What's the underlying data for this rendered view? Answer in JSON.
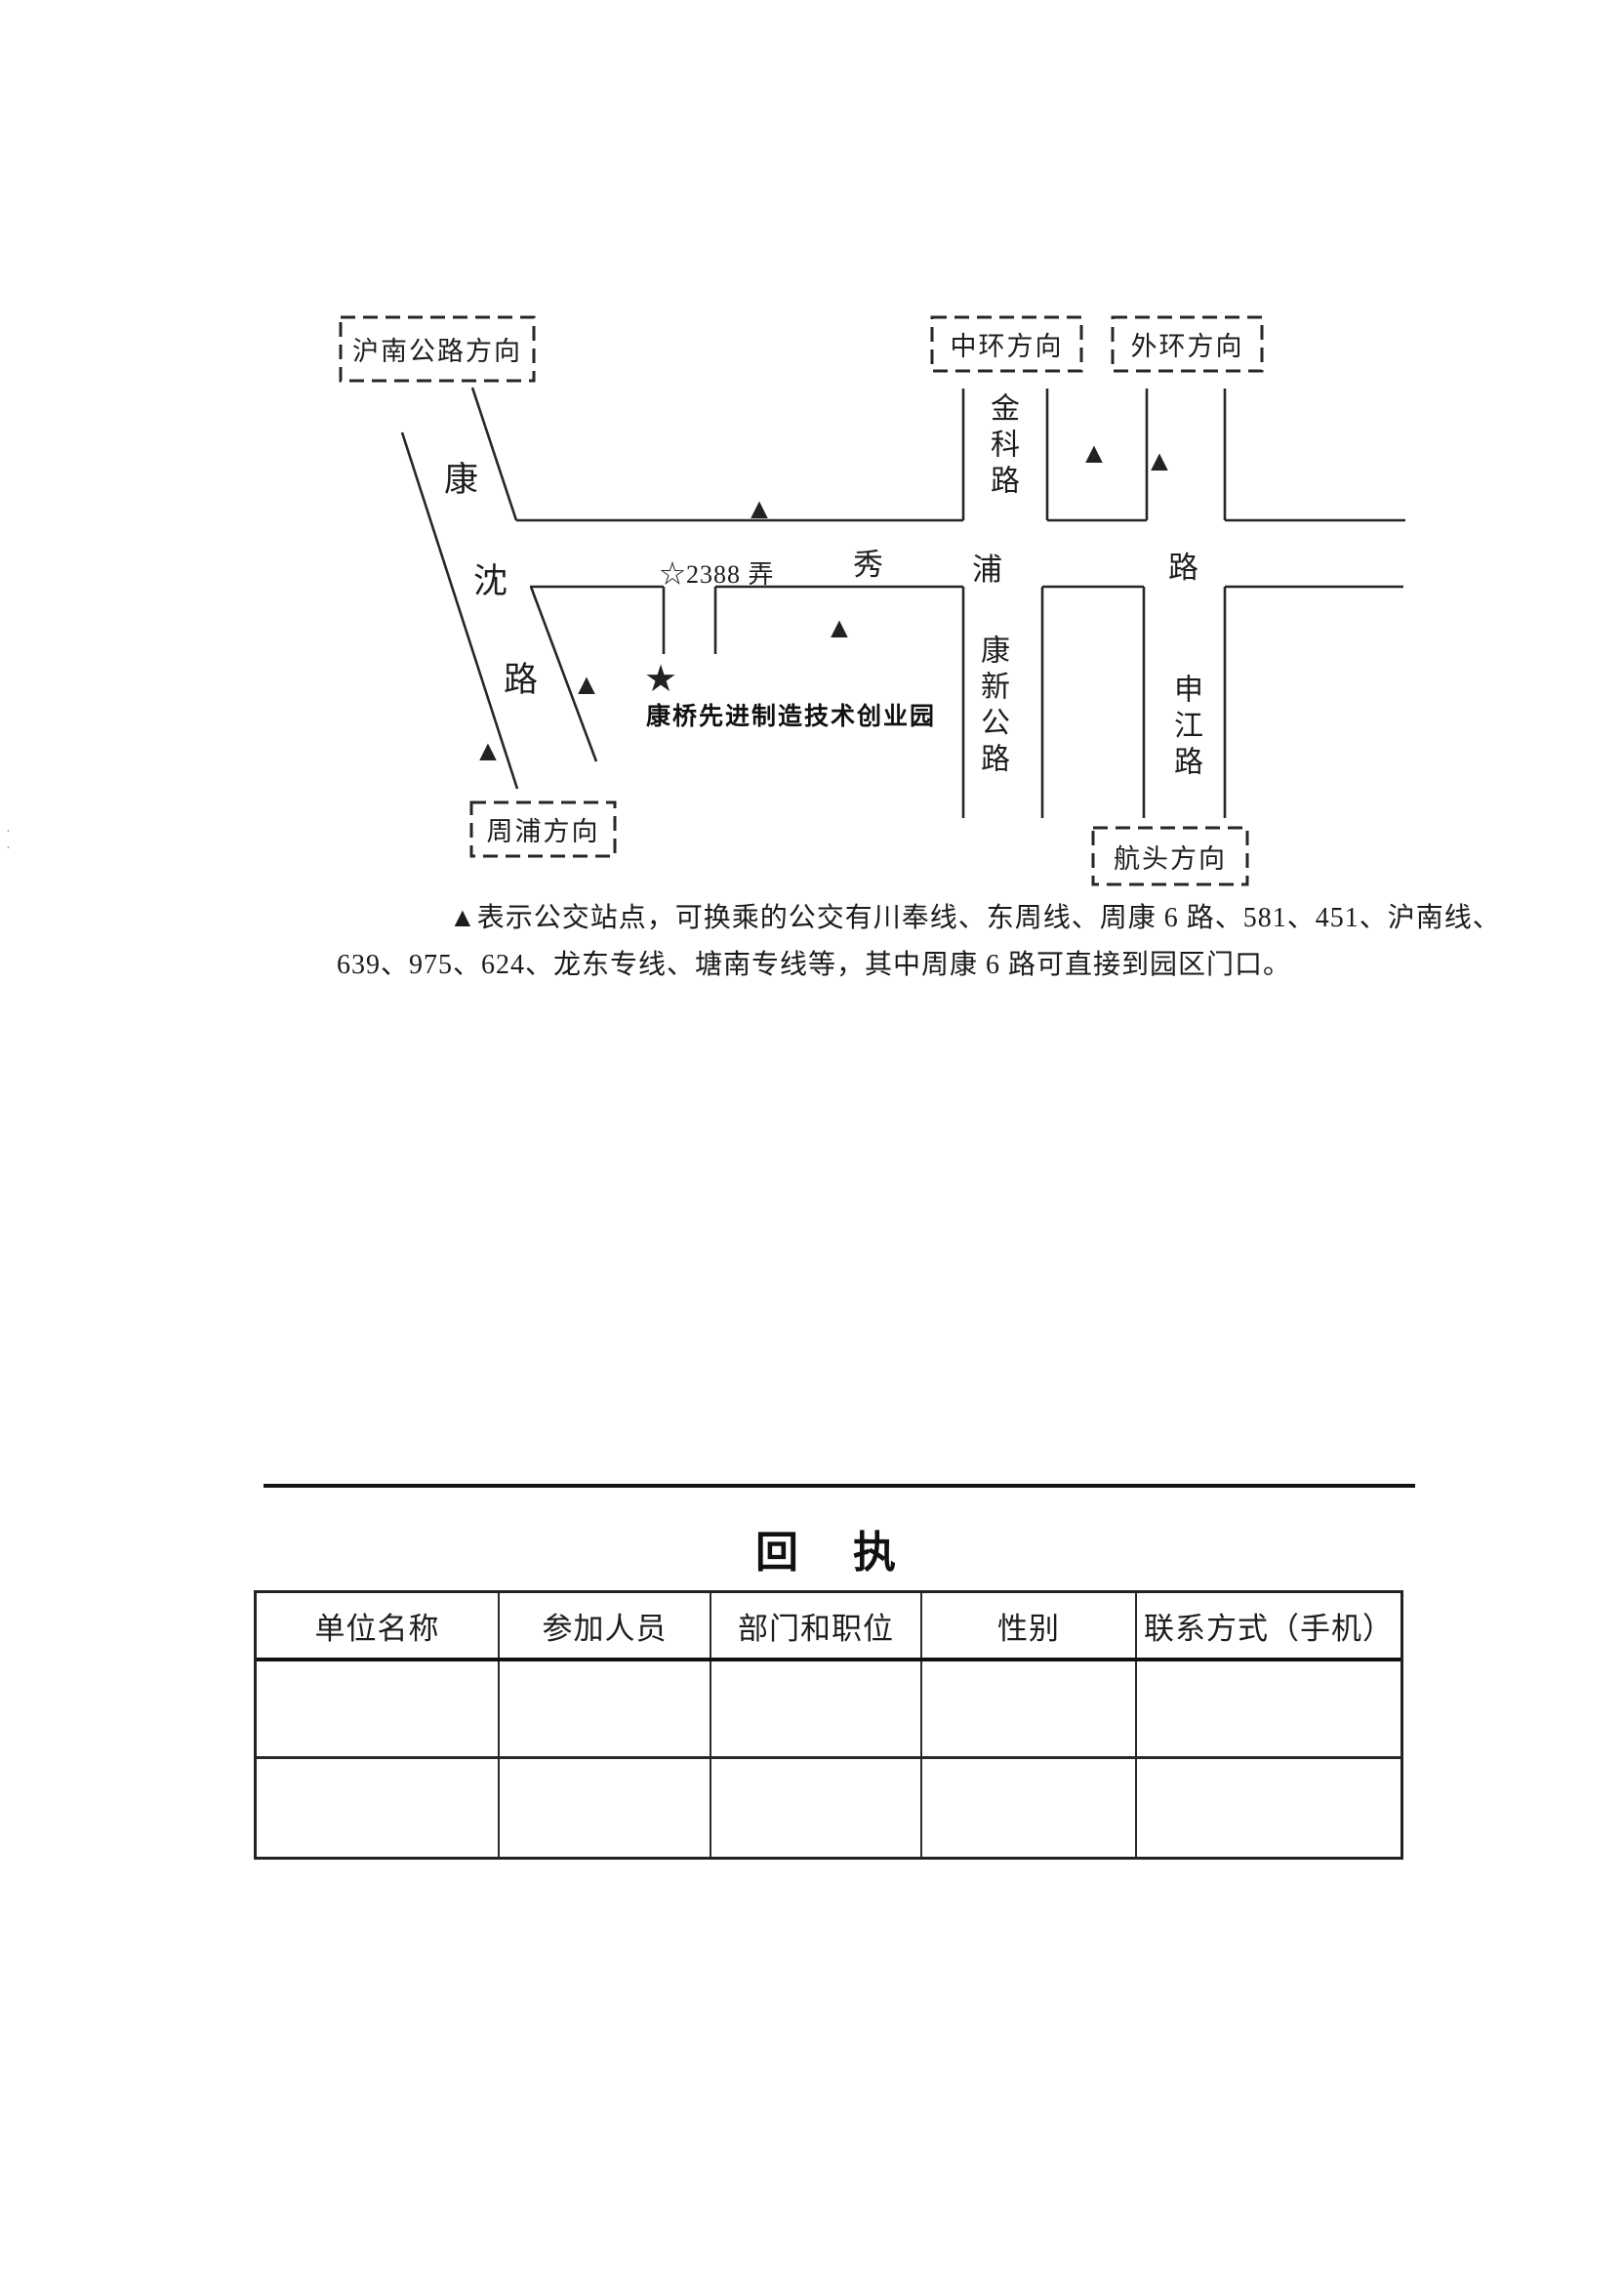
{
  "map": {
    "direction_boxes": {
      "hunan_highway": "沪南公路方向",
      "zhonghuan": "中环方向",
      "waihuan": "外环方向",
      "zhoupu": "周浦方向",
      "hangtou": "航头方向"
    },
    "road_names": {
      "kangshen": "康沈路",
      "xiupu": "秀浦路",
      "jinke": "金科路",
      "kangxin": "康新公路",
      "shenjiang": "申江路"
    },
    "entrance_label": "☆2388 弄",
    "park_label": "康桥先进制造技术创业园",
    "symbols": {
      "bus_stop": "▲",
      "park_star": "★"
    }
  },
  "legend": {
    "line1": "▲表示公交站点，可换乘的公交有川奉线、东周线、周康 6 路、581、451、沪南线、",
    "line2": "639、975、624、龙东专线、塘南专线等，其中周康 6 路可直接到园区门口。"
  },
  "reply_form": {
    "title": "回　执",
    "table": {
      "headers": [
        "单位名称",
        "参加人员",
        "部门和职位",
        "性别",
        "联系方式（手机）"
      ]
    }
  }
}
